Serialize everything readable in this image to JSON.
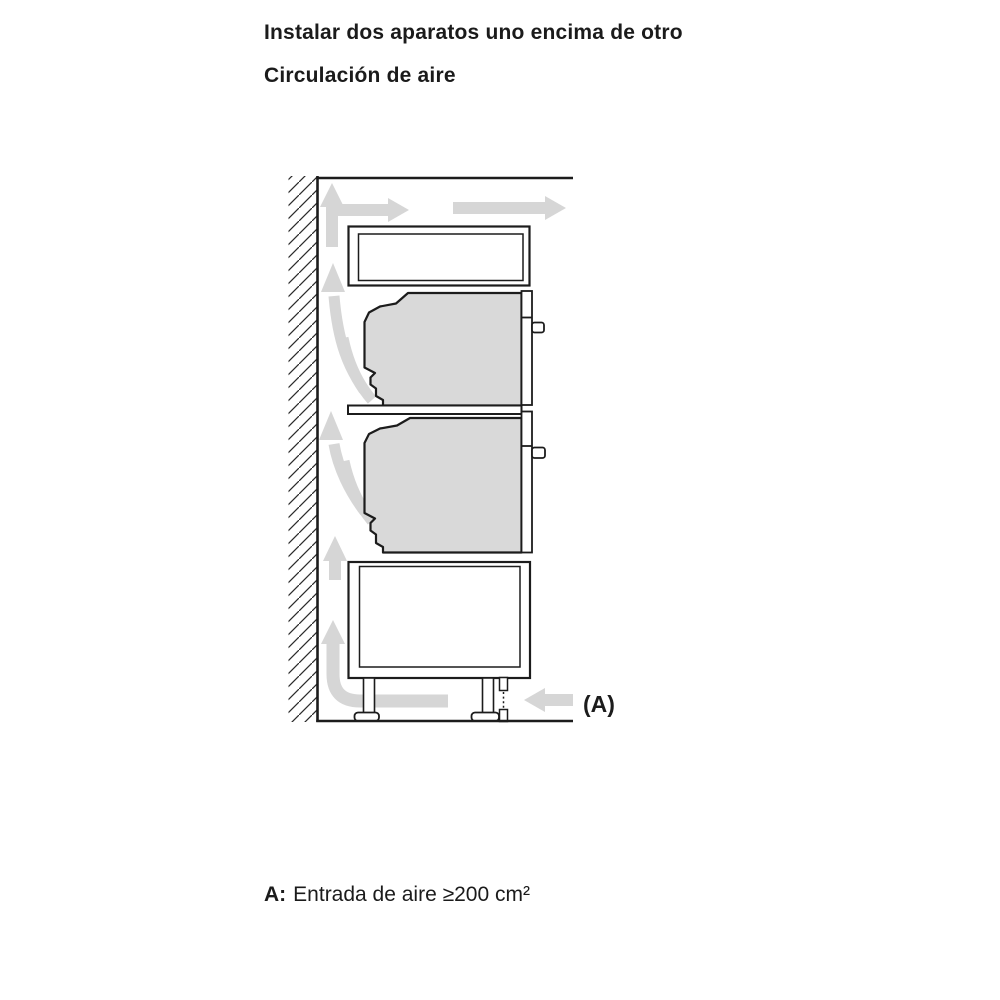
{
  "header": {
    "title": "Instalar dos aparatos uno encima de otro",
    "subtitle": "Circulación de aire"
  },
  "diagram": {
    "label_a": "(A)",
    "colors": {
      "line": "#1c1c1c",
      "appliance_fill": "#d9d9d9",
      "arrow_fill": "#d6d6d6",
      "hatch_line": "#2b2b2b",
      "background": "#ffffff"
    }
  },
  "caption": {
    "label": "A:",
    "text": "Entrada de aire ≥200 cm²"
  }
}
